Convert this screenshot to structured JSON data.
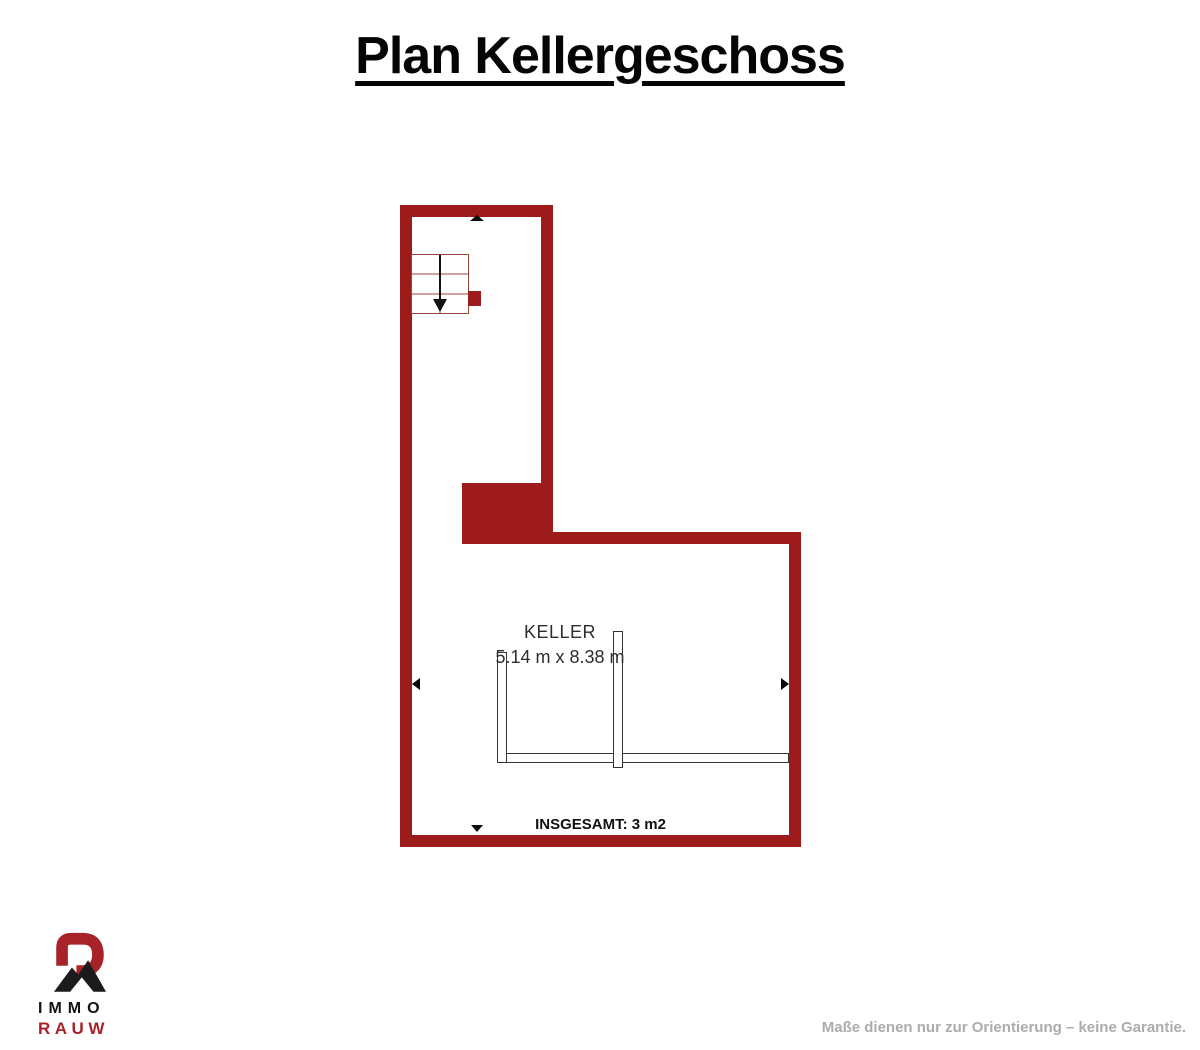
{
  "title": "Plan Kellergeschoss",
  "plan": {
    "room": {
      "name": "KELLER",
      "dimensions": "5.14 m x 8.38 m"
    },
    "total_label": "INSGESAMT: 3 m2"
  },
  "logo": {
    "line1": "IMMO",
    "line2": "RAUW"
  },
  "footer": {
    "disclaimer": "Maße dienen nur zur Orientierung – keine Garantie."
  },
  "colors": {
    "wall": "#9E1B1B",
    "stair_line": "#9b443c",
    "logo_red": "#A8222A",
    "logo_black": "#1b1b1b",
    "text_dark": "#2d2d2d",
    "text_muted": "#ACACAC"
  }
}
